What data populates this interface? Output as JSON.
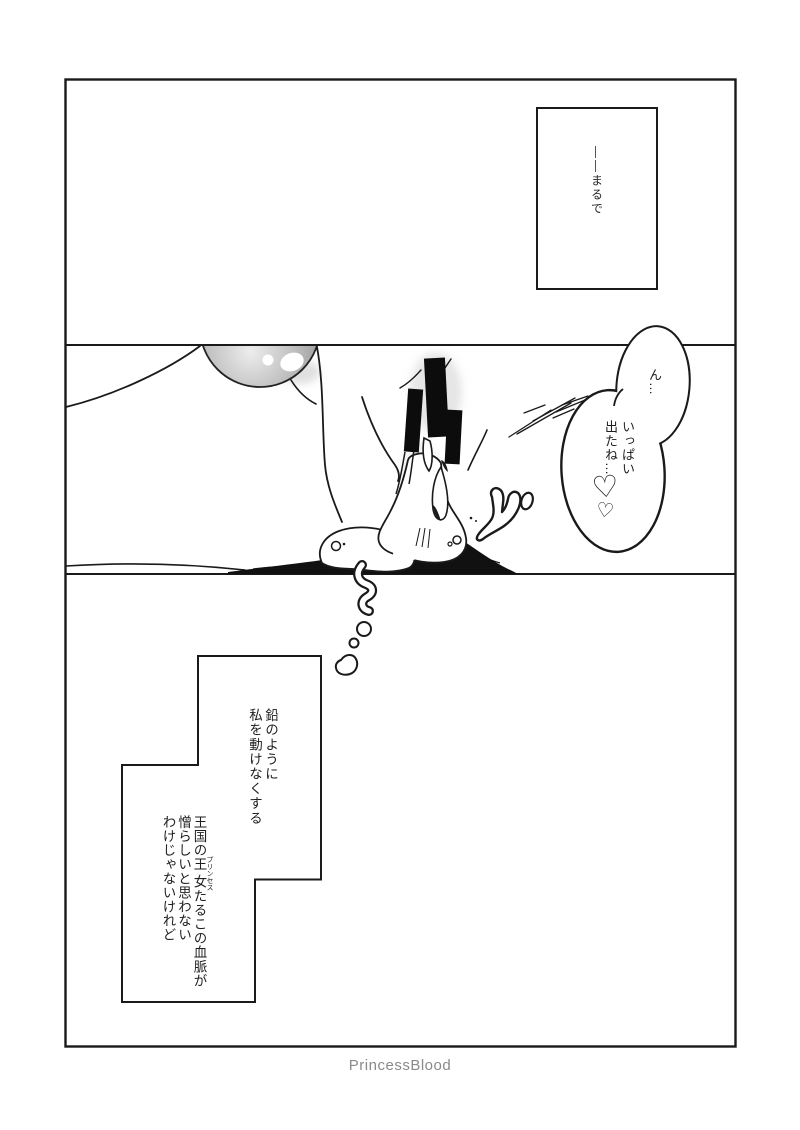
{
  "page": {
    "background": "#ffffff",
    "ink_color": "#1a1a1a",
    "footer_credit": "PrincessBlood",
    "footer_color": "#8a8a8a"
  },
  "art_colors": {
    "orb_light": "#ededed",
    "orb_dark": "#8e8e8e",
    "censor_bar": "#0c0c0c",
    "ink_mound": "#111111"
  },
  "top_panel": {
    "caption": "――まるで"
  },
  "middle_panel": {
    "speech_bubble": {
      "upper_text": "ん…",
      "lower_text_col1": "いっぱい",
      "lower_text_col2": "出たね…",
      "heart_icons": [
        "♡",
        "♡"
      ]
    }
  },
  "bottom_panel": {
    "monologue_upper": {
      "col1": "鉛のように",
      "col2": "私を動けなくする"
    },
    "monologue_lower": {
      "col1_pre": "王国の",
      "col1_ruby_base": "王女",
      "col1_ruby_text": "プリンセス",
      "col1_post": "たるこの血脈が",
      "col2": "憎らしいと思わない",
      "col3": "わけじゃないけれど"
    }
  }
}
